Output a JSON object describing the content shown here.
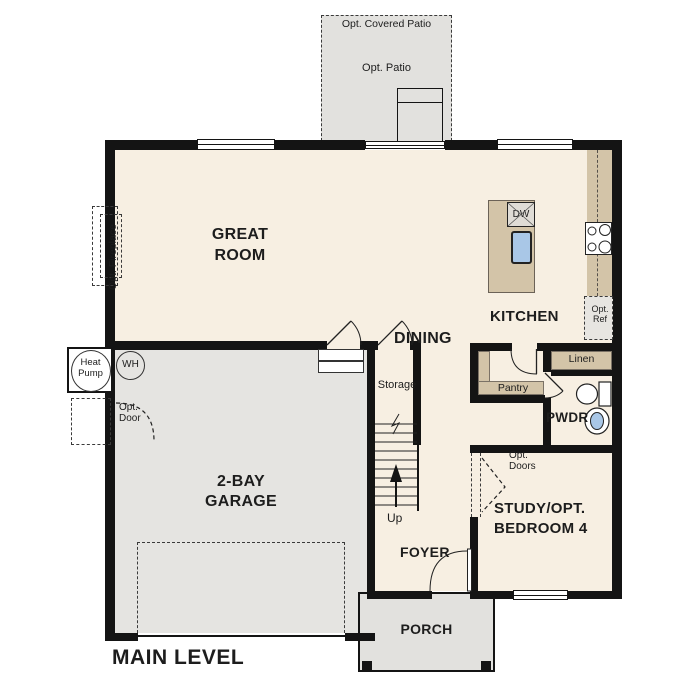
{
  "plan": {
    "title": "MAIN LEVEL",
    "rooms": {
      "great_room": "GREAT ROOM",
      "dining": "DINING",
      "kitchen": "KITCHEN",
      "garage": "2-BAY GARAGE",
      "study": "STUDY/OPT. BEDROOM 4",
      "foyer": "FOYER",
      "porch": "PORCH",
      "powder": "PWDR",
      "storage": "Storage",
      "pantry": "Pantry",
      "linen": "Linen"
    },
    "features": {
      "opt_covered_patio": "Opt. Covered Patio",
      "opt_patio": "Opt. Patio",
      "opt_fireplace": "Opt. Fireplace",
      "opt_ref": "Opt. Ref",
      "opt_door": "Opt. Door",
      "opt_doors": "Opt. Doors",
      "heat_pump": "Heat Pump",
      "water_heater": "WH",
      "dishwasher": "DW",
      "stairs_up": "Up"
    },
    "colors": {
      "wall": "#141414",
      "interior": "#f7efe2",
      "garage": "#e5e4e1",
      "patio": "#e2e1de",
      "counter": "#d3c4a8",
      "sink_water": "#a9c7e7"
    }
  }
}
